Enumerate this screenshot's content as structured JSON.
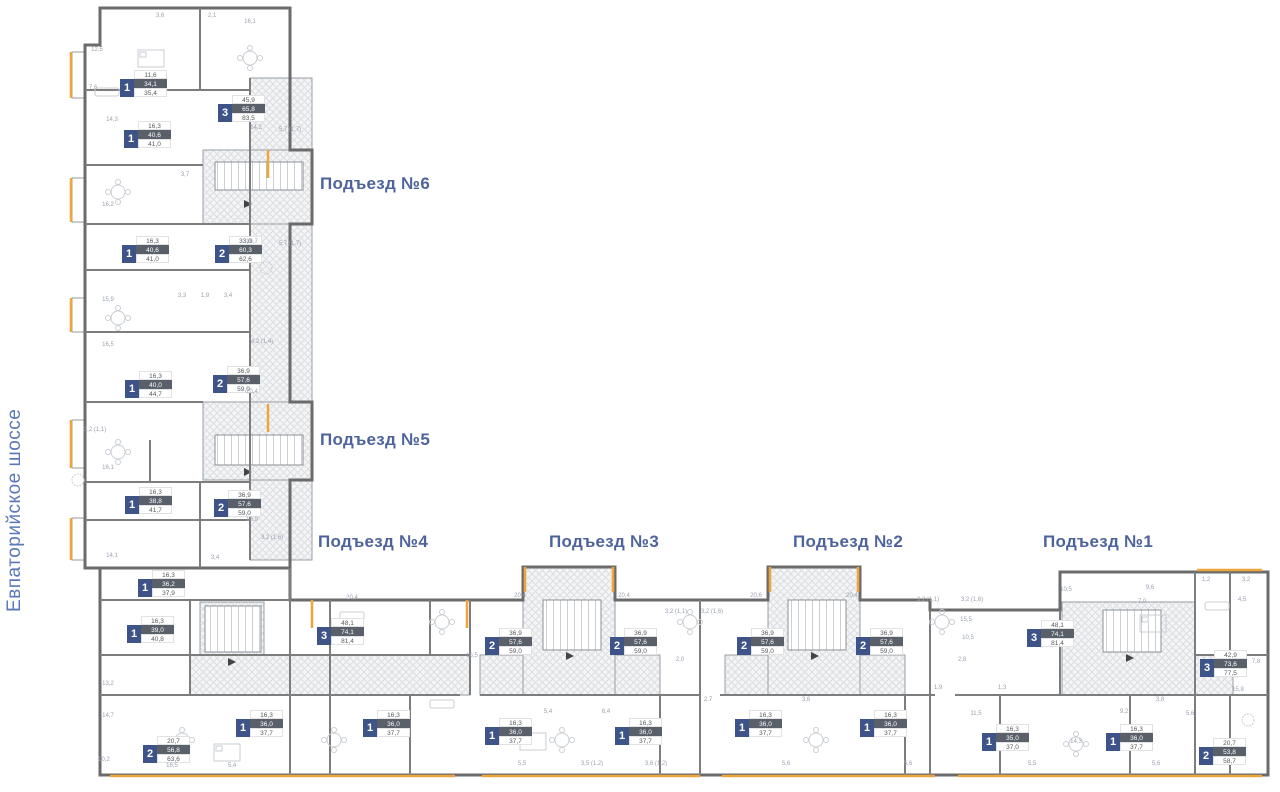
{
  "street_label": "Евпаторийское шоссе",
  "entrances": [
    {
      "n": "6",
      "label": "Подъезд №6",
      "x": 320,
      "y": 174
    },
    {
      "n": "5",
      "label": "Подъезд №5",
      "x": 320,
      "y": 430
    },
    {
      "n": "4",
      "label": "Подъезд №4",
      "x": 318,
      "y": 532
    },
    {
      "n": "3",
      "label": "Подъезд №3",
      "x": 549,
      "y": 532
    },
    {
      "n": "2",
      "label": "Подъезд №2",
      "x": 793,
      "y": 532
    },
    {
      "n": "1",
      "label": "Подъезд №1",
      "x": 1043,
      "y": 532
    }
  ],
  "apartments": [
    {
      "rooms": "1",
      "values": [
        "11,6",
        "34,1",
        "35,4"
      ],
      "x": 120,
      "y": 70
    },
    {
      "rooms": "3",
      "values": [
        "45,9",
        "65,8",
        "83,5"
      ],
      "x": 218,
      "y": 95
    },
    {
      "rooms": "1",
      "values": [
        "16,3",
        "40,6",
        "41,0"
      ],
      "x": 124,
      "y": 121
    },
    {
      "rooms": "1",
      "values": [
        "16,3",
        "40,6",
        "41,0"
      ],
      "x": 122,
      "y": 236
    },
    {
      "rooms": "2",
      "values": [
        "33,0",
        "60,3",
        "62,6"
      ],
      "x": 215,
      "y": 236
    },
    {
      "rooms": "1",
      "values": [
        "16,3",
        "40,0",
        "44,7"
      ],
      "x": 125,
      "y": 371
    },
    {
      "rooms": "2",
      "values": [
        "36,9",
        "57,6",
        "59,0"
      ],
      "x": 213,
      "y": 366
    },
    {
      "rooms": "1",
      "values": [
        "16,3",
        "38,8",
        "41,7"
      ],
      "x": 125,
      "y": 487
    },
    {
      "rooms": "2",
      "values": [
        "36,9",
        "57,6",
        "59,0"
      ],
      "x": 214,
      "y": 490
    },
    {
      "rooms": "1",
      "values": [
        "16,3",
        "36,2",
        "37,9"
      ],
      "x": 138,
      "y": 570
    },
    {
      "rooms": "1",
      "values": [
        "16,3",
        "39,0",
        "40,8"
      ],
      "x": 127,
      "y": 616
    },
    {
      "rooms": "3",
      "values": [
        "48,1",
        "74,1",
        "81,4"
      ],
      "x": 317,
      "y": 618
    },
    {
      "rooms": "2",
      "values": [
        "36,9",
        "57,6",
        "59,0"
      ],
      "x": 485,
      "y": 628
    },
    {
      "rooms": "2",
      "values": [
        "36,9",
        "57,6",
        "59,0"
      ],
      "x": 610,
      "y": 628
    },
    {
      "rooms": "2",
      "values": [
        "36,9",
        "57,6",
        "59,0"
      ],
      "x": 737,
      "y": 628
    },
    {
      "rooms": "2",
      "values": [
        "36,9",
        "57,6",
        "59,0"
      ],
      "x": 856,
      "y": 628
    },
    {
      "rooms": "3",
      "values": [
        "48,1",
        "74,1",
        "81,4"
      ],
      "x": 1027,
      "y": 620
    },
    {
      "rooms": "3",
      "values": [
        "42,9",
        "73,6",
        "77,5"
      ],
      "x": 1200,
      "y": 650
    },
    {
      "rooms": "2",
      "values": [
        "20,7",
        "56,8",
        "63,6"
      ],
      "x": 143,
      "y": 736
    },
    {
      "rooms": "1",
      "values": [
        "16,3",
        "36,0",
        "37,7"
      ],
      "x": 236,
      "y": 710
    },
    {
      "rooms": "1",
      "values": [
        "16,3",
        "36,0",
        "37,7"
      ],
      "x": 363,
      "y": 710
    },
    {
      "rooms": "1",
      "values": [
        "16,3",
        "36,0",
        "37,7"
      ],
      "x": 485,
      "y": 718
    },
    {
      "rooms": "1",
      "values": [
        "16,3",
        "36,0",
        "37,7"
      ],
      "x": 615,
      "y": 718
    },
    {
      "rooms": "1",
      "values": [
        "16,3",
        "36,0",
        "37,7"
      ],
      "x": 735,
      "y": 710
    },
    {
      "rooms": "1",
      "values": [
        "16,3",
        "36,0",
        "37,7"
      ],
      "x": 860,
      "y": 710
    },
    {
      "rooms": "1",
      "values": [
        "16,3",
        "35,0",
        "37,0"
      ],
      "x": 982,
      "y": 724
    },
    {
      "rooms": "1",
      "values": [
        "16,3",
        "36,0",
        "37,7"
      ],
      "x": 1106,
      "y": 724
    },
    {
      "rooms": "2",
      "values": [
        "20,7",
        "53,8",
        "58,7"
      ],
      "x": 1199,
      "y": 738
    }
  ],
  "dims": [
    {
      "t": "12,5",
      "x": 97,
      "y": 50
    },
    {
      "t": "3,6",
      "x": 160,
      "y": 16
    },
    {
      "t": "2,1",
      "x": 212,
      "y": 16
    },
    {
      "t": "16,1",
      "x": 250,
      "y": 22
    },
    {
      "t": "7,6",
      "x": 93,
      "y": 88
    },
    {
      "t": "14,3",
      "x": 112,
      "y": 120
    },
    {
      "t": "14,2",
      "x": 256,
      "y": 128
    },
    {
      "t": "5,7 (1,7)",
      "x": 290,
      "y": 130
    },
    {
      "t": "16,2",
      "x": 108,
      "y": 205
    },
    {
      "t": "3,7",
      "x": 185,
      "y": 175
    },
    {
      "t": "16,7",
      "x": 252,
      "y": 242
    },
    {
      "t": "5,7 (1,7)",
      "x": 290,
      "y": 244
    },
    {
      "t": "15,9",
      "x": 108,
      "y": 300
    },
    {
      "t": "3,3",
      "x": 182,
      "y": 296
    },
    {
      "t": "1,9",
      "x": 205,
      "y": 296
    },
    {
      "t": "3,4",
      "x": 228,
      "y": 296
    },
    {
      "t": "16,5",
      "x": 108,
      "y": 345
    },
    {
      "t": "4,2 (1,4)",
      "x": 262,
      "y": 342
    },
    {
      "t": "20,4",
      "x": 252,
      "y": 392
    },
    {
      "t": "3,2 (1,1)",
      "x": 95,
      "y": 430
    },
    {
      "t": "16,1",
      "x": 108,
      "y": 468
    },
    {
      "t": "16,9",
      "x": 252,
      "y": 520
    },
    {
      "t": "3,2 (1,6)",
      "x": 272,
      "y": 538
    },
    {
      "t": "14,1",
      "x": 112,
      "y": 556
    },
    {
      "t": "3,4",
      "x": 215,
      "y": 558
    },
    {
      "t": "20,4",
      "x": 352,
      "y": 598
    },
    {
      "t": "20,4",
      "x": 520,
      "y": 596
    },
    {
      "t": "20,4",
      "x": 624,
      "y": 596
    },
    {
      "t": "20,6",
      "x": 756,
      "y": 596
    },
    {
      "t": "20,4",
      "x": 852,
      "y": 596
    },
    {
      "t": "3,2 (1,1)",
      "x": 928,
      "y": 600
    },
    {
      "t": "3,2 (1,6)",
      "x": 972,
      "y": 600
    },
    {
      "t": "10,5",
      "x": 1066,
      "y": 590
    },
    {
      "t": "9,6",
      "x": 1150,
      "y": 588
    },
    {
      "t": "1,2",
      "x": 1206,
      "y": 580
    },
    {
      "t": "3,2",
      "x": 1246,
      "y": 580
    },
    {
      "t": "7,0",
      "x": 1142,
      "y": 602
    },
    {
      "t": "4,5",
      "x": 1242,
      "y": 600
    },
    {
      "t": "10,5",
      "x": 968,
      "y": 638
    },
    {
      "t": "2,8",
      "x": 962,
      "y": 660
    },
    {
      "t": "15,5",
      "x": 966,
      "y": 620
    },
    {
      "t": "1,9",
      "x": 938,
      "y": 688
    },
    {
      "t": "1,3",
      "x": 1002,
      "y": 688
    },
    {
      "t": "11,5",
      "x": 976,
      "y": 714
    },
    {
      "t": "9,2",
      "x": 1124,
      "y": 712
    },
    {
      "t": "3,8",
      "x": 1160,
      "y": 700
    },
    {
      "t": "5,6",
      "x": 1190,
      "y": 714
    },
    {
      "t": "14,3",
      "x": 1076,
      "y": 742
    },
    {
      "t": "15,8",
      "x": 1238,
      "y": 690
    },
    {
      "t": "7,8",
      "x": 1256,
      "y": 662
    },
    {
      "t": "13,2",
      "x": 108,
      "y": 684
    },
    {
      "t": "14,7",
      "x": 108,
      "y": 716
    },
    {
      "t": "16,5",
      "x": 172,
      "y": 766
    },
    {
      "t": "5,4",
      "x": 232,
      "y": 766
    },
    {
      "t": "10,2",
      "x": 104,
      "y": 760
    },
    {
      "t": "16,5",
      "x": 472,
      "y": 656
    },
    {
      "t": "5,5",
      "x": 522,
      "y": 764
    },
    {
      "t": "3,5 (1,2)",
      "x": 592,
      "y": 764
    },
    {
      "t": "3,6 (1,2)",
      "x": 656,
      "y": 764
    },
    {
      "t": "5,6",
      "x": 786,
      "y": 764
    },
    {
      "t": "5,6",
      "x": 908,
      "y": 764
    },
    {
      "t": "5,5",
      "x": 1032,
      "y": 764
    },
    {
      "t": "5,6",
      "x": 1156,
      "y": 764
    },
    {
      "t": "2,7",
      "x": 708,
      "y": 700
    },
    {
      "t": "3,8",
      "x": 806,
      "y": 700
    },
    {
      "t": "5,4",
      "x": 548,
      "y": 712
    },
    {
      "t": "6,4",
      "x": 606,
      "y": 712
    },
    {
      "t": "2,0",
      "x": 680,
      "y": 660
    },
    {
      "t": "3,2 (1,6)",
      "x": 712,
      "y": 612
    },
    {
      "t": "3,2 (1,1)",
      "x": 676,
      "y": 612
    }
  ],
  "colors": {
    "accent_yellow": "#ECA63C",
    "badge_navy": "#3E5488",
    "badge_dark_strip": "#5A6069",
    "label_blue": "#4E639B",
    "street_blue": "#5B79B8",
    "wall_gray": "#6B6B6B"
  }
}
